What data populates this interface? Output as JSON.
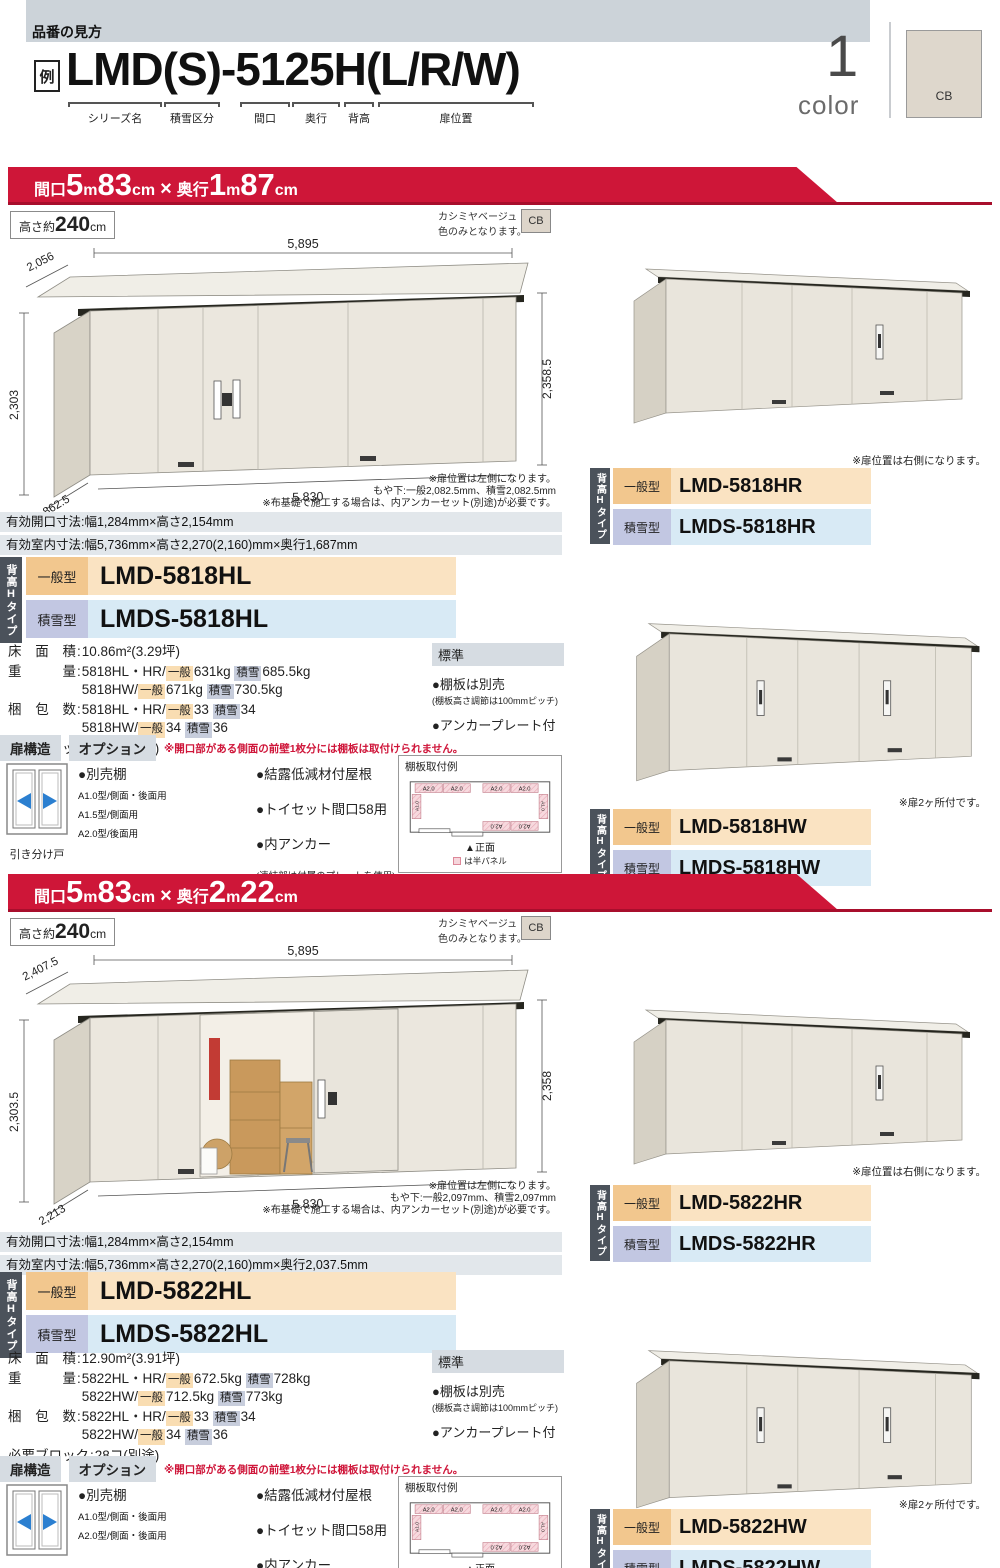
{
  "header": {
    "section_label": "品番の見方",
    "example_tag": "例",
    "example_code": "LMD(S)-5125H(L/R/W)",
    "code_parts": [
      "シリーズ名",
      "積雪区分",
      "間口",
      "奥行",
      "背高",
      "扉位置"
    ],
    "color_count": "1",
    "color_word": "color",
    "color_code": "CB"
  },
  "sections": [
    {
      "banner_parts": [
        [
          "間口",
          "bs"
        ],
        [
          "5",
          "bl"
        ],
        [
          "m",
          "bs"
        ],
        [
          "83",
          "bl"
        ],
        [
          "cm",
          "bs"
        ],
        [
          "×",
          "bm"
        ],
        [
          "奥行",
          "bs"
        ],
        [
          "1",
          "bl"
        ],
        [
          "m",
          "bs"
        ],
        [
          "87",
          "bl"
        ],
        [
          "cm",
          "bs"
        ]
      ],
      "height_parts": [
        [
          "高さ約",
          "hs"
        ],
        [
          "240",
          "hl"
        ],
        [
          "cm",
          "hs"
        ]
      ],
      "color_note": [
        "カシミヤベージュ",
        "色のみとなります。"
      ],
      "color_code": "CB",
      "drawing": {
        "door_open": false,
        "dim_depth_top": "2,056",
        "dim_width_top": "5,895",
        "dim_height_left": "2,303",
        "dim_height_right": "2,358.5",
        "dim_depth_bottom": "1,862.5",
        "dim_width_bottom": "5,830",
        "notes": [
          "※扉位置は左側になります。",
          "もや下:一般2,082.5mm、積雪2,082.5mm",
          "※布基礎で施工する場合は、内アンカーセット(別途)が必要です。"
        ]
      },
      "dim_rows": [
        "有効開口寸法:幅1,284mm×高さ2,154mm",
        "有効室内寸法:幅5,736mm×高さ2,270(2,160)mm×奥行1,687mm"
      ],
      "type_tab": "背高Hタイプ",
      "models": [
        {
          "type": "一般型",
          "code": "LMD-5818HL"
        },
        {
          "type": "積雪型",
          "code": "LMDS-5818HL"
        }
      ],
      "specs": [
        {
          "label": "床 面 積",
          "lines": [
            [
              {
                "t": "10.86m²(3.29坪)"
              }
            ]
          ]
        },
        {
          "label": "重   量",
          "lines": [
            [
              {
                "t": "5818HL・HR/"
              },
              {
                "t": "一般",
                "c": "o"
              },
              {
                "t": "631kg "
              },
              {
                "t": "積雪",
                "c": "b"
              },
              {
                "t": "685.5kg"
              }
            ],
            [
              {
                "t": "5818HW/"
              },
              {
                "t": "一般",
                "c": "o"
              },
              {
                "t": "671kg "
              },
              {
                "t": "積雪",
                "c": "b"
              },
              {
                "t": "730.5kg"
              }
            ]
          ]
        },
        {
          "label": "梱 包 数",
          "lines": [
            [
              {
                "t": "5818HL・HR/"
              },
              {
                "t": "一般",
                "c": "o"
              },
              {
                "t": "33 "
              },
              {
                "t": "積雪",
                "c": "b"
              },
              {
                "t": "34"
              }
            ],
            [
              {
                "t": "5818HW/"
              },
              {
                "t": "一般",
                "c": "o"
              },
              {
                "t": "34 "
              },
              {
                "t": "積雪",
                "c": "b"
              },
              {
                "t": "36"
              }
            ]
          ]
        },
        {
          "label": "必要ブロック",
          "lines": [
            [
              {
                "t": "28コ(別途)"
              }
            ]
          ]
        }
      ],
      "standard": {
        "title": "標準",
        "items": [
          {
            "main": "●棚板は別売",
            "sub": "(棚板高さ調節は100mmピッチ)"
          },
          {
            "main": "●アンカープレート付",
            "sub": ""
          }
        ]
      },
      "door_header": "扉構造",
      "option_header": "オプション",
      "option_note": "※開口部がある側面の前壁1枚分には棚板は取付けられません。",
      "door_caption": "引き分け戸",
      "shelf_option": {
        "title": "●別売棚",
        "items": [
          "A1.0型/側面・後面用",
          "A1.5型/側面用",
          "A2.0型/後面用"
        ]
      },
      "option_items": [
        "●結露低減材付屋根",
        "●トイセット間口58用",
        "●内アンカー"
      ],
      "option_footnote": "(連結部は付属のプレートを使用)",
      "shelf_example": {
        "title": "棚板取付例",
        "front": "▲正面",
        "legend": "は半パネル",
        "a2": "A2.0",
        "a1": "A1.0"
      },
      "right_units": [
        {
          "note": "※扉位置は右側になります。",
          "two_doors": false,
          "models": [
            {
              "type": "一般型",
              "code": "LMD-5818HR"
            },
            {
              "type": "積雪型",
              "code": "LMDS-5818HR"
            }
          ]
        },
        {
          "note": "※扉2ヶ所付です。",
          "two_doors": true,
          "models": [
            {
              "type": "一般型",
              "code": "LMD-5818HW"
            },
            {
              "type": "積雪型",
              "code": "LMDS-5818HW"
            }
          ]
        }
      ]
    },
    {
      "banner_parts": [
        [
          "間口",
          "bs"
        ],
        [
          "5",
          "bl"
        ],
        [
          "m",
          "bs"
        ],
        [
          "83",
          "bl"
        ],
        [
          "cm",
          "bs"
        ],
        [
          "×",
          "bm"
        ],
        [
          "奥行",
          "bs"
        ],
        [
          "2",
          "bl"
        ],
        [
          "m",
          "bs"
        ],
        [
          "22",
          "bl"
        ],
        [
          "cm",
          "bs"
        ]
      ],
      "height_parts": [
        [
          "高さ約",
          "hs"
        ],
        [
          "240",
          "hl"
        ],
        [
          "cm",
          "hs"
        ]
      ],
      "color_note": [
        "カシミヤベージュ",
        "色のみとなります。"
      ],
      "color_code": "CB",
      "drawing": {
        "door_open": true,
        "dim_depth_top": "2,407.5",
        "dim_width_top": "5,895",
        "dim_height_left": "2,303.5",
        "dim_height_right": "2,358",
        "dim_depth_bottom": "2,213",
        "dim_width_bottom": "5,830",
        "notes": [
          "※扉位置は左側になります。",
          "もや下:一般2,097mm、積雪2,097mm",
          "※布基礎で施工する場合は、内アンカーセット(別途)が必要です。"
        ]
      },
      "dim_rows": [
        "有効開口寸法:幅1,284mm×高さ2,154mm",
        "有効室内寸法:幅5,736mm×高さ2,270(2,160)mm×奥行2,037.5mm"
      ],
      "type_tab": "背高Hタイプ",
      "models": [
        {
          "type": "一般型",
          "code": "LMD-5822HL"
        },
        {
          "type": "積雪型",
          "code": "LMDS-5822HL"
        }
      ],
      "specs": [
        {
          "label": "床 面 積",
          "lines": [
            [
              {
                "t": "12.90m²(3.91坪)"
              }
            ]
          ]
        },
        {
          "label": "重   量",
          "lines": [
            [
              {
                "t": "5822HL・HR/"
              },
              {
                "t": "一般",
                "c": "o"
              },
              {
                "t": "672.5kg "
              },
              {
                "t": "積雪",
                "c": "b"
              },
              {
                "t": "728kg"
              }
            ],
            [
              {
                "t": "5822HW/"
              },
              {
                "t": "一般",
                "c": "o"
              },
              {
                "t": "712.5kg "
              },
              {
                "t": "積雪",
                "c": "b"
              },
              {
                "t": "773kg"
              }
            ]
          ]
        },
        {
          "label": "梱 包 数",
          "lines": [
            [
              {
                "t": "5822HL・HR/"
              },
              {
                "t": "一般",
                "c": "o"
              },
              {
                "t": "33 "
              },
              {
                "t": "積雪",
                "c": "b"
              },
              {
                "t": "34"
              }
            ],
            [
              {
                "t": "5822HW/"
              },
              {
                "t": "一般",
                "c": "o"
              },
              {
                "t": "34 "
              },
              {
                "t": "積雪",
                "c": "b"
              },
              {
                "t": "36"
              }
            ]
          ]
        },
        {
          "label": "必要ブロック",
          "lines": [
            [
              {
                "t": "28コ(別途)"
              }
            ]
          ]
        }
      ],
      "standard": {
        "title": "標準",
        "items": [
          {
            "main": "●棚板は別売",
            "sub": "(棚板高さ調節は100mmピッチ)"
          },
          {
            "main": "●アンカープレート付",
            "sub": ""
          }
        ]
      },
      "door_header": "扉構造",
      "option_header": "オプション",
      "option_note": "※開口部がある側面の前壁1枚分には棚板は取付けられません。",
      "door_caption": "引き分け戸",
      "shelf_option": {
        "title": "●別売棚",
        "items": [
          "A1.0型/側面・後面用",
          "A2.0型/側面・後面用"
        ]
      },
      "option_items": [
        "●結露低減材付屋根",
        "●トイセット間口58用",
        "●内アンカー"
      ],
      "option_footnote": "(連結部は付属のプレートを使用)",
      "shelf_example": {
        "title": "棚板取付例",
        "front": "▲正面",
        "legend": "は半パネル",
        "a2": "A2.0",
        "a1": "A1.0"
      },
      "right_units": [
        {
          "note": "※扉位置は右側になります。",
          "two_doors": false,
          "models": [
            {
              "type": "一般型",
              "code": "LMD-5822HR"
            },
            {
              "type": "積雪型",
              "code": "LMDS-5822HR"
            }
          ]
        },
        {
          "note": "※扉2ヶ所付です。",
          "two_doors": true,
          "models": [
            {
              "type": "一般型",
              "code": "LMD-5822HW"
            },
            {
              "type": "積雪型",
              "code": "LMDS-5822HW"
            }
          ]
        }
      ]
    }
  ]
}
